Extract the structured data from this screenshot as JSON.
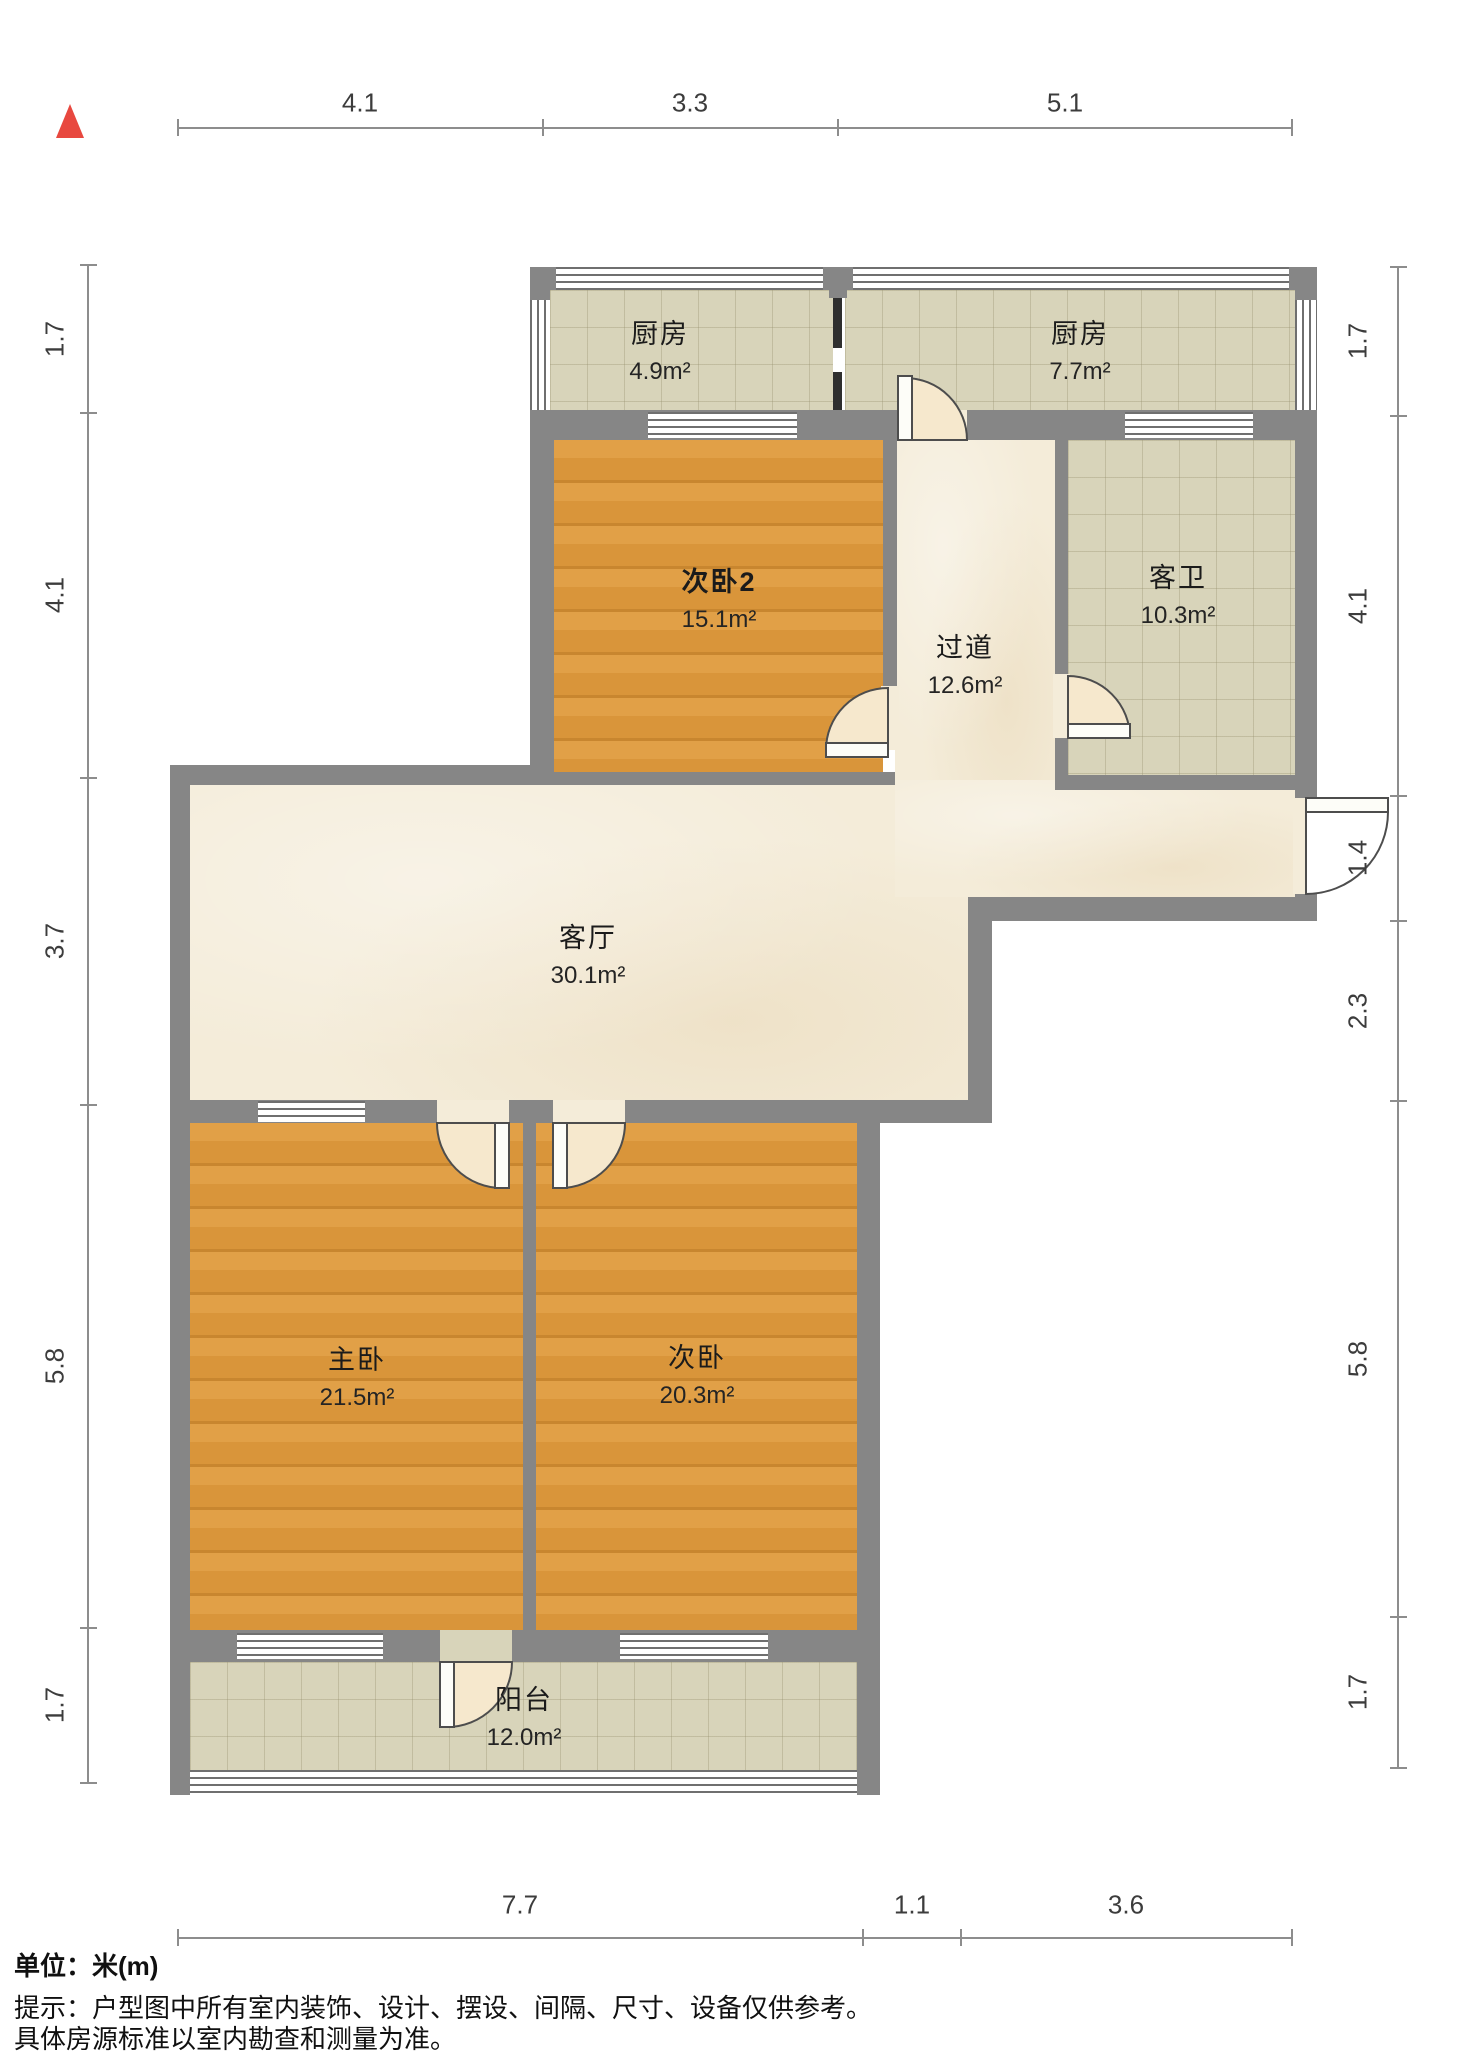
{
  "rooms": {
    "kitchen_small": {
      "name": "厨房",
      "area": "4.9m²"
    },
    "kitchen_large": {
      "name": "厨房",
      "area": "7.7m²"
    },
    "bedroom2": {
      "name": "次卧2",
      "area": "15.1m²"
    },
    "corridor": {
      "name": "过道",
      "area": "12.6m²"
    },
    "guest_bath": {
      "name": "客卫",
      "area": "10.3m²"
    },
    "living": {
      "name": "客厅",
      "area": "30.1m²"
    },
    "master": {
      "name": "主卧",
      "area": "21.5m²"
    },
    "bedroom": {
      "name": "次卧",
      "area": "20.3m²"
    },
    "balcony": {
      "name": "阳台",
      "area": "12.0m²"
    }
  },
  "dimensions": {
    "top": [
      "4.1",
      "3.3",
      "5.1"
    ],
    "left": [
      "1.7",
      "4.1",
      "3.7",
      "5.8",
      "1.7"
    ],
    "right": [
      "1.7",
      "4.1",
      "1.4",
      "2.3",
      "5.8",
      "1.7"
    ],
    "bottom": [
      "7.7",
      "1.1",
      "3.6"
    ]
  },
  "notes": {
    "unit_label": "单位：米(m)",
    "tip_line1": "提示：户型图中所有室内装饰、设计、摆设、间隔、尺寸、设备仅供参考。",
    "tip_line2": "具体房源标准以室内勘查和测量为准。"
  },
  "colors": {
    "wall": "#868686",
    "wood_floor": "#dd9b40",
    "tile_floor": "#d8d4ba",
    "marble_floor": "#f4ecd9",
    "north_arrow": "#e8483f"
  }
}
